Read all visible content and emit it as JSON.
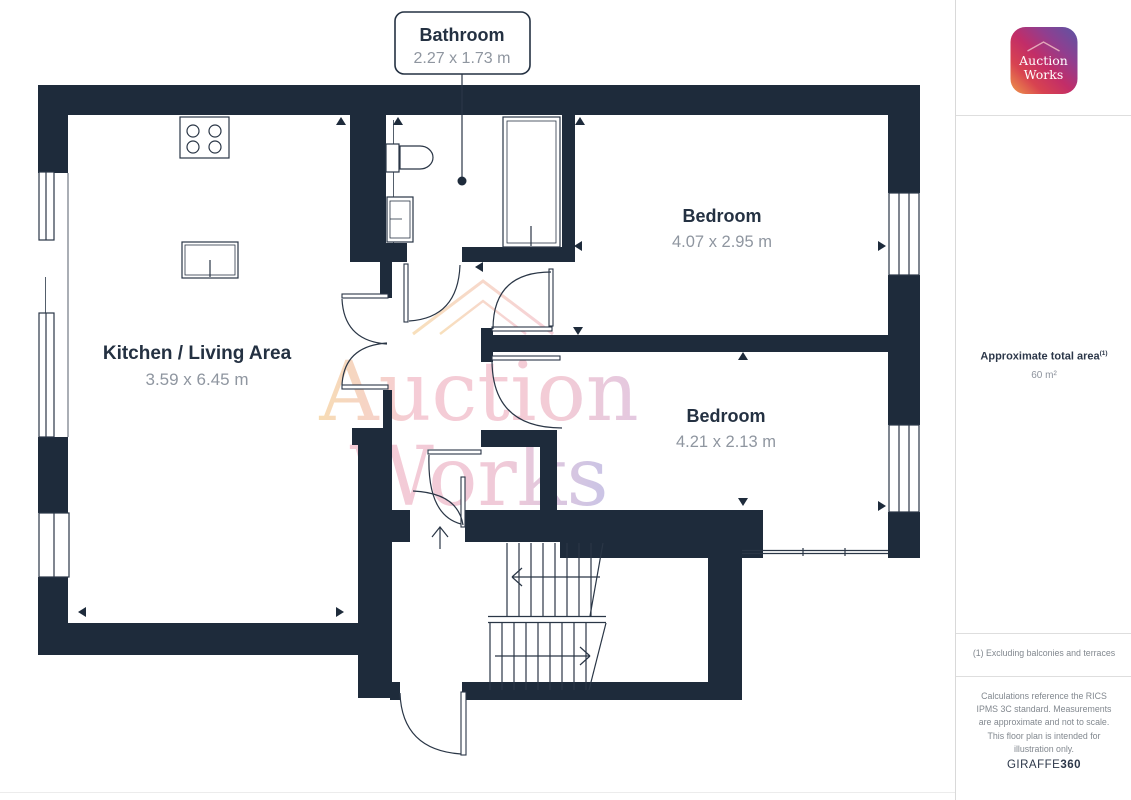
{
  "plan": {
    "callout": {
      "title": "Bathroom",
      "dims": "2.27 x 1.73 m"
    },
    "rooms": [
      {
        "name": "Kitchen / Living Area",
        "dims": "3.59 x 6.45 m"
      },
      {
        "name": "Bedroom",
        "dims": "4.07 x 2.95 m"
      },
      {
        "name": "Bedroom",
        "dims": "4.21 x 2.13 m"
      }
    ],
    "watermark": {
      "line1": "Auction",
      "line2": "Works"
    },
    "colors": {
      "wall": "#1e2b3b",
      "label_text": "#243142",
      "dim_text": "#8f96a0",
      "watermark_orange": "#f7dcb4",
      "watermark_pink": "#f5ccd6",
      "watermark_purple": "#c9c4e6"
    }
  },
  "sidebar": {
    "logo": {
      "line1": "Auction",
      "line2": "Works"
    },
    "area_label": "Approximate total area",
    "area_superscript": "(1)",
    "area_value": "60 m²",
    "footnote": "(1) Excluding balconies and terraces",
    "disclaimer": "Calculations reference the RICS IPMS 3C standard. Measurements are approximate and not to scale. This floor plan is intended for illustration only.",
    "brand": {
      "name": "GIRAFFE",
      "suffix": "360"
    }
  }
}
